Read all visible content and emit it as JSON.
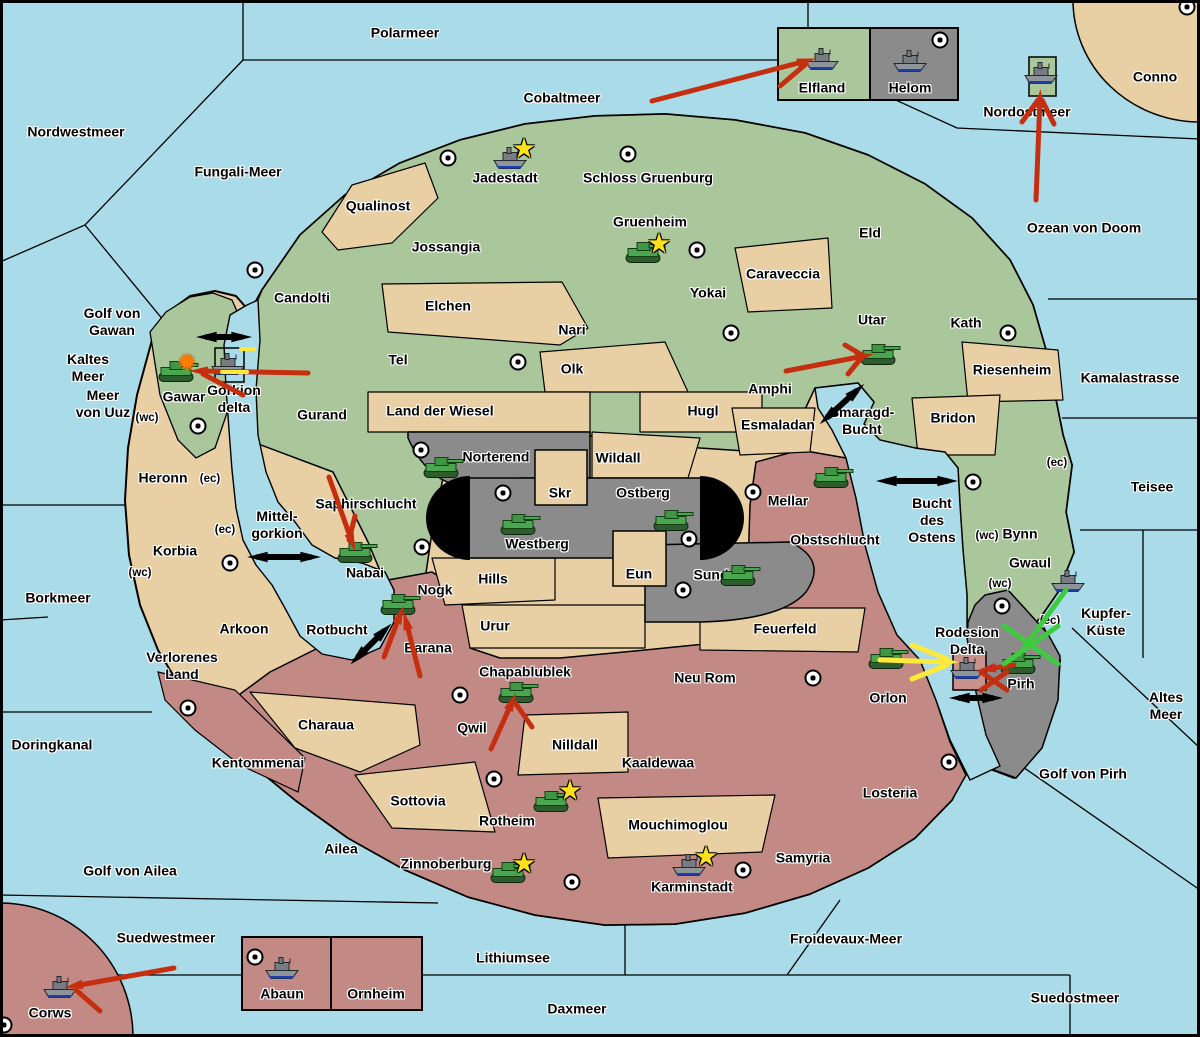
{
  "colors": {
    "sea": "#A9DBE8",
    "land_green": "#A9C79B",
    "land_tan": "#E9D0A4",
    "land_red": "#C38984",
    "land_gray": "#8B8B8B",
    "delta_pink": "#C9918C",
    "arrow_red": "#C62E10",
    "arrow_yellow": "#FFE93B",
    "arrow_green": "#3ECC3E",
    "connector_black": "#000000",
    "star_yellow": "#FFE11A",
    "burst_orange": "#FF7D00"
  },
  "sea_labels": [
    {
      "text": "Polarmeer",
      "x": 405,
      "y": 33
    },
    {
      "text": "Cobaltmeer",
      "x": 562,
      "y": 98
    },
    {
      "text": "Nordwestmeer",
      "x": 76,
      "y": 132
    },
    {
      "text": "Fungali-Meer",
      "x": 238,
      "y": 172
    },
    {
      "text": "Nordostmeer",
      "x": 1027,
      "y": 112
    },
    {
      "text": "Ozean von Doom",
      "x": 1084,
      "y": 228
    },
    {
      "text": "Golf von\nGawan",
      "x": 112,
      "y": 322
    },
    {
      "text": "Kaltes\nMeer",
      "x": 88,
      "y": 368
    },
    {
      "text": "Meer\nvon Uuz",
      "x": 103,
      "y": 404
    },
    {
      "text": "Borkmeer",
      "x": 58,
      "y": 598
    },
    {
      "text": "Mittel-\ngorkion",
      "x": 277,
      "y": 525
    },
    {
      "text": "Gorkion\ndelta",
      "x": 234,
      "y": 399
    },
    {
      "text": "Rotbucht",
      "x": 337,
      "y": 630
    },
    {
      "text": "Smaragd-\nBucht",
      "x": 862,
      "y": 421
    },
    {
      "text": "Bucht\ndes\nOstens",
      "x": 932,
      "y": 520
    },
    {
      "text": "Kamalastrasse",
      "x": 1130,
      "y": 378
    },
    {
      "text": "Teisee",
      "x": 1152,
      "y": 487
    },
    {
      "text": "Kupfer-\nKüste",
      "x": 1106,
      "y": 622
    },
    {
      "text": "Altes\nMeer",
      "x": 1166,
      "y": 706
    },
    {
      "text": "Golf von Pirh",
      "x": 1083,
      "y": 774
    },
    {
      "text": "Doringkanal",
      "x": 52,
      "y": 745
    },
    {
      "text": "Golf von Ailea",
      "x": 130,
      "y": 871
    },
    {
      "text": "Suedwestmeer",
      "x": 166,
      "y": 938
    },
    {
      "text": "Lithiumsee",
      "x": 513,
      "y": 958
    },
    {
      "text": "Daxmeer",
      "x": 577,
      "y": 1009
    },
    {
      "text": "Froidevaux-Meer",
      "x": 846,
      "y": 939
    },
    {
      "text": "Suedostmeer",
      "x": 1075,
      "y": 998
    },
    {
      "text": "Rodesion\nDelta",
      "x": 967,
      "y": 641
    }
  ],
  "territories": [
    {
      "name": "Jadestadt",
      "x": 505,
      "y": 178,
      "region": "green"
    },
    {
      "name": "Schloss Gruenburg",
      "x": 648,
      "y": 178,
      "region": "green"
    },
    {
      "name": "Gruenheim",
      "x": 650,
      "y": 222,
      "region": "green"
    },
    {
      "name": "Jossangia",
      "x": 446,
      "y": 247,
      "region": "green"
    },
    {
      "name": "Candolti",
      "x": 302,
      "y": 298,
      "region": "green"
    },
    {
      "name": "Qualinost",
      "x": 378,
      "y": 206,
      "region": "tan"
    },
    {
      "name": "Elchen",
      "x": 448,
      "y": 306,
      "region": "tan"
    },
    {
      "name": "Nari",
      "x": 572,
      "y": 330,
      "region": "green"
    },
    {
      "name": "Tel",
      "x": 398,
      "y": 360,
      "region": "green"
    },
    {
      "name": "Olk",
      "x": 572,
      "y": 369,
      "region": "tan"
    },
    {
      "name": "Yokai",
      "x": 708,
      "y": 293,
      "region": "green"
    },
    {
      "name": "Caraveccia",
      "x": 783,
      "y": 274,
      "region": "tan"
    },
    {
      "name": "Eld",
      "x": 870,
      "y": 233,
      "region": "green"
    },
    {
      "name": "Utar",
      "x": 872,
      "y": 320,
      "region": "green"
    },
    {
      "name": "Kath",
      "x": 966,
      "y": 323,
      "region": "green"
    },
    {
      "name": "Riesenheim",
      "x": 1012,
      "y": 370,
      "region": "tan"
    },
    {
      "name": "Bridon",
      "x": 953,
      "y": 418,
      "region": "tan"
    },
    {
      "name": "Amphi",
      "x": 770,
      "y": 389,
      "region": "green"
    },
    {
      "name": "Hugl",
      "x": 703,
      "y": 411,
      "region": "tan"
    },
    {
      "name": "Esmaladan",
      "x": 778,
      "y": 425,
      "region": "tan"
    },
    {
      "name": "Land der Wiesel",
      "x": 440,
      "y": 411,
      "region": "tan"
    },
    {
      "name": "Gurand",
      "x": 322,
      "y": 415,
      "region": "green"
    },
    {
      "name": "Gawar",
      "x": 184,
      "y": 397,
      "region": "green"
    },
    {
      "name": "Heronn",
      "x": 163,
      "y": 478,
      "region": "tan"
    },
    {
      "name": "Korbia",
      "x": 175,
      "y": 551,
      "region": "tan"
    },
    {
      "name": "Arkoon",
      "x": 244,
      "y": 629,
      "region": "tan"
    },
    {
      "name": "Verlorenes\nLand",
      "x": 182,
      "y": 666,
      "region": "tan"
    },
    {
      "name": "Saphirschlucht",
      "x": 366,
      "y": 504,
      "region": "green"
    },
    {
      "name": "Nabai",
      "x": 365,
      "y": 573,
      "region": "green"
    },
    {
      "name": "Norterend",
      "x": 496,
      "y": 457,
      "region": "gray"
    },
    {
      "name": "Skr",
      "x": 560,
      "y": 493,
      "region": "tan"
    },
    {
      "name": "Wildall",
      "x": 618,
      "y": 458,
      "region": "tan"
    },
    {
      "name": "Westberg",
      "x": 537,
      "y": 544,
      "region": "gray"
    },
    {
      "name": "Ostberg",
      "x": 643,
      "y": 493,
      "region": "gray"
    },
    {
      "name": "Eun",
      "x": 639,
      "y": 574,
      "region": "tan"
    },
    {
      "name": "Sund",
      "x": 711,
      "y": 575,
      "region": "gray"
    },
    {
      "name": "Mellar",
      "x": 788,
      "y": 501,
      "region": "red"
    },
    {
      "name": "Obstschlucht",
      "x": 835,
      "y": 540,
      "region": "red"
    },
    {
      "name": "Hills",
      "x": 493,
      "y": 579,
      "region": "tan"
    },
    {
      "name": "Urur",
      "x": 495,
      "y": 626,
      "region": "tan"
    },
    {
      "name": "Nogk",
      "x": 435,
      "y": 590,
      "region": "red"
    },
    {
      "name": "Barana",
      "x": 428,
      "y": 648,
      "region": "red"
    },
    {
      "name": "Chapablublek",
      "x": 525,
      "y": 672,
      "region": "red"
    },
    {
      "name": "Qwil",
      "x": 472,
      "y": 728,
      "region": "red"
    },
    {
      "name": "Neu Rom",
      "x": 705,
      "y": 678,
      "region": "red"
    },
    {
      "name": "Feuerfeld",
      "x": 785,
      "y": 629,
      "region": "tan"
    },
    {
      "name": "Nilldall",
      "x": 575,
      "y": 745,
      "region": "tan"
    },
    {
      "name": "Kaaldewaa",
      "x": 658,
      "y": 763,
      "region": "red"
    },
    {
      "name": "Mouchimoglou",
      "x": 678,
      "y": 825,
      "region": "tan"
    },
    {
      "name": "Charaua",
      "x": 326,
      "y": 725,
      "region": "tan"
    },
    {
      "name": "Kentommenai",
      "x": 258,
      "y": 763,
      "region": "red"
    },
    {
      "name": "Sottovia",
      "x": 418,
      "y": 801,
      "region": "tan"
    },
    {
      "name": "Ailea",
      "x": 341,
      "y": 849,
      "region": "red"
    },
    {
      "name": "Zinnoberburg",
      "x": 446,
      "y": 864,
      "region": "red"
    },
    {
      "name": "Rotheim",
      "x": 507,
      "y": 821,
      "region": "red"
    },
    {
      "name": "Karminstadt",
      "x": 692,
      "y": 887,
      "region": "red"
    },
    {
      "name": "Samyria",
      "x": 803,
      "y": 858,
      "region": "red"
    },
    {
      "name": "Losteria",
      "x": 890,
      "y": 793,
      "region": "red"
    },
    {
      "name": "Orlon",
      "x": 888,
      "y": 698,
      "region": "red"
    },
    {
      "name": "Bynn",
      "x": 1020,
      "y": 534,
      "region": "green"
    },
    {
      "name": "Gwaul",
      "x": 1030,
      "y": 563,
      "region": "green"
    },
    {
      "name": "Pirh",
      "x": 1021,
      "y": 684,
      "region": "gray"
    },
    {
      "name": "Elfland",
      "x": 822,
      "y": 88,
      "region": "green"
    },
    {
      "name": "Helom",
      "x": 910,
      "y": 88,
      "region": "gray"
    },
    {
      "name": "Conno",
      "x": 1155,
      "y": 77,
      "region": "tan"
    },
    {
      "name": "Abaun",
      "x": 282,
      "y": 994,
      "region": "red"
    },
    {
      "name": "Ornheim",
      "x": 376,
      "y": 994,
      "region": "red"
    },
    {
      "name": "Corws",
      "x": 50,
      "y": 1013,
      "region": "red"
    }
  ],
  "coast_tags": [
    {
      "text": "(wc)",
      "x": 147,
      "y": 419
    },
    {
      "text": "(ec)",
      "x": 210,
      "y": 480
    },
    {
      "text": "(ec)",
      "x": 225,
      "y": 531
    },
    {
      "text": "(wc)",
      "x": 140,
      "y": 574
    },
    {
      "text": "(ec)",
      "x": 1057,
      "y": 464
    },
    {
      "text": "(wc)",
      "x": 987,
      "y": 537
    },
    {
      "text": "(wc)",
      "x": 1000,
      "y": 585
    },
    {
      "text": "(ec)",
      "x": 1050,
      "y": 622
    }
  ],
  "city_markers": [
    {
      "x": 448,
      "y": 158
    },
    {
      "x": 628,
      "y": 154
    },
    {
      "x": 697,
      "y": 250
    },
    {
      "x": 255,
      "y": 270
    },
    {
      "x": 518,
      "y": 362
    },
    {
      "x": 731,
      "y": 333
    },
    {
      "x": 1008,
      "y": 333
    },
    {
      "x": 973,
      "y": 482
    },
    {
      "x": 940,
      "y": 40
    },
    {
      "x": 1187,
      "y": 7
    },
    {
      "x": 198,
      "y": 426
    },
    {
      "x": 230,
      "y": 563
    },
    {
      "x": 421,
      "y": 450
    },
    {
      "x": 503,
      "y": 493
    },
    {
      "x": 689,
      "y": 539
    },
    {
      "x": 683,
      "y": 590
    },
    {
      "x": 753,
      "y": 492
    },
    {
      "x": 422,
      "y": 547
    },
    {
      "x": 460,
      "y": 695
    },
    {
      "x": 188,
      "y": 708
    },
    {
      "x": 813,
      "y": 678
    },
    {
      "x": 949,
      "y": 762
    },
    {
      "x": 1002,
      "y": 606
    },
    {
      "x": 572,
      "y": 882
    },
    {
      "x": 743,
      "y": 870
    },
    {
      "x": 255,
      "y": 957
    },
    {
      "x": 4,
      "y": 1025
    },
    {
      "x": 494,
      "y": 779
    }
  ],
  "units": {
    "tanks": [
      {
        "x": 645,
        "y": 255,
        "at": "Gruenheim"
      },
      {
        "x": 178,
        "y": 374,
        "at": "Gawar"
      },
      {
        "x": 880,
        "y": 357,
        "at": "Utar"
      },
      {
        "x": 357,
        "y": 555,
        "at": "Nabai"
      },
      {
        "x": 443,
        "y": 470,
        "at": "Norterend"
      },
      {
        "x": 520,
        "y": 527,
        "at": "Westberg"
      },
      {
        "x": 673,
        "y": 523,
        "at": "Ostberg"
      },
      {
        "x": 740,
        "y": 578,
        "at": "Sund"
      },
      {
        "x": 833,
        "y": 480,
        "at": "Mellar"
      },
      {
        "x": 400,
        "y": 607,
        "at": "Nogk"
      },
      {
        "x": 518,
        "y": 695,
        "at": "Chapablublek"
      },
      {
        "x": 888,
        "y": 661,
        "at": "Orlon"
      },
      {
        "x": 553,
        "y": 804,
        "at": "Rotheim"
      },
      {
        "x": 510,
        "y": 875,
        "at": "Zinnoberburg"
      },
      {
        "x": 1020,
        "y": 666,
        "at": "Pirh"
      }
    ],
    "ships": [
      {
        "x": 510,
        "y": 161,
        "at": "Jadestadt"
      },
      {
        "x": 822,
        "y": 62,
        "at": "Elfland"
      },
      {
        "x": 910,
        "y": 64,
        "at": "Helom"
      },
      {
        "x": 1041,
        "y": 76,
        "at": "Nordostmeer"
      },
      {
        "x": 228,
        "y": 367,
        "at": "Gorkion delta"
      },
      {
        "x": 1068,
        "y": 584,
        "at": "Gwaul"
      },
      {
        "x": 967,
        "y": 671,
        "at": "Rodesion Delta"
      },
      {
        "x": 689,
        "y": 868,
        "at": "Karminstadt"
      },
      {
        "x": 282,
        "y": 971,
        "at": "Abaun"
      },
      {
        "x": 60,
        "y": 990,
        "at": "Corws"
      }
    ],
    "stars": [
      {
        "x": 524,
        "y": 149,
        "at": "Jadestadt"
      },
      {
        "x": 659,
        "y": 244,
        "at": "Gruenheim"
      },
      {
        "x": 570,
        "y": 791,
        "at": "Rotheim"
      },
      {
        "x": 524,
        "y": 864,
        "at": "Zinnoberburg"
      },
      {
        "x": 706,
        "y": 857,
        "at": "Karminstadt"
      }
    ],
    "bursts": [
      {
        "x": 187,
        "y": 363,
        "at": "Gawar"
      }
    ]
  },
  "arrows": [
    {
      "color": "red",
      "x1": 652,
      "y1": 101,
      "x2": 806,
      "y2": 61,
      "head": true
    },
    {
      "color": "red",
      "x1": 780,
      "y1": 86,
      "x2": 806,
      "y2": 64,
      "head": false
    },
    {
      "color": "red",
      "x1": 1036,
      "y1": 200,
      "x2": 1040,
      "y2": 99,
      "head": true
    },
    {
      "color": "red",
      "x1": 1022,
      "y1": 122,
      "x2": 1038,
      "y2": 100,
      "head": false
    },
    {
      "color": "red",
      "x1": 1054,
      "y1": 124,
      "x2": 1042,
      "y2": 100,
      "head": false
    },
    {
      "color": "red",
      "x1": 308,
      "y1": 373,
      "x2": 199,
      "y2": 371,
      "head": true
    },
    {
      "color": "red",
      "x1": 243,
      "y1": 395,
      "x2": 203,
      "y2": 374,
      "head": false
    },
    {
      "color": "red",
      "x1": 786,
      "y1": 371,
      "x2": 864,
      "y2": 356,
      "head": true
    },
    {
      "color": "red",
      "x1": 845,
      "y1": 345,
      "x2": 862,
      "y2": 355,
      "head": false
    },
    {
      "color": "red",
      "x1": 848,
      "y1": 374,
      "x2": 862,
      "y2": 357,
      "head": false
    },
    {
      "color": "red",
      "x1": 329,
      "y1": 477,
      "x2": 352,
      "y2": 542,
      "head": true
    },
    {
      "color": "red",
      "x1": 355,
      "y1": 516,
      "x2": 349,
      "y2": 540,
      "head": false
    },
    {
      "color": "red",
      "x1": 384,
      "y1": 657,
      "x2": 400,
      "y2": 615,
      "head": true
    },
    {
      "color": "red",
      "x1": 420,
      "y1": 676,
      "x2": 406,
      "y2": 621,
      "head": true
    },
    {
      "color": "red",
      "x1": 491,
      "y1": 749,
      "x2": 512,
      "y2": 702,
      "head": true
    },
    {
      "color": "red",
      "x1": 532,
      "y1": 727,
      "x2": 516,
      "y2": 704,
      "head": false
    },
    {
      "color": "red",
      "x1": 174,
      "y1": 968,
      "x2": 74,
      "y2": 986,
      "head": true
    },
    {
      "color": "red",
      "x1": 100,
      "y1": 1011,
      "x2": 76,
      "y2": 990,
      "head": false
    },
    {
      "color": "red",
      "x1": 1014,
      "y1": 665,
      "x2": 987,
      "y2": 669,
      "head": true
    },
    {
      "color": "yellow",
      "x1": 880,
      "y1": 660,
      "x2": 949,
      "y2": 662,
      "head": true
    },
    {
      "color": "yellow",
      "x1": 912,
      "y1": 645,
      "x2": 947,
      "y2": 659,
      "head": false
    },
    {
      "color": "yellow",
      "x1": 912,
      "y1": 679,
      "x2": 947,
      "y2": 665,
      "head": false
    },
    {
      "color": "green",
      "x1": 1066,
      "y1": 590,
      "x2": 1024,
      "y2": 648,
      "head": false
    }
  ],
  "sea_connectors": [
    {
      "x": 224,
      "y": 337,
      "len": 34,
      "angle": 0
    },
    {
      "x": 284,
      "y": 557,
      "len": 52,
      "angle": 0
    },
    {
      "x": 371,
      "y": 644,
      "len": 36,
      "angle": -45
    },
    {
      "x": 842,
      "y": 404,
      "len": 38,
      "angle": -42
    },
    {
      "x": 917,
      "y": 481,
      "len": 60,
      "angle": 0
    },
    {
      "x": 976,
      "y": 698,
      "len": 32,
      "angle": 0
    }
  ],
  "crosses": [
    {
      "x": 1031,
      "y": 645,
      "size": 27,
      "color": "green"
    },
    {
      "x": 994,
      "y": 681,
      "size": 13,
      "color": "red"
    }
  ],
  "yellow_dashes": [
    {
      "x1": 241,
      "y1": 349,
      "x2": 254,
      "y2": 349
    },
    {
      "x1": 222,
      "y1": 372,
      "x2": 247,
      "y2": 372
    }
  ]
}
